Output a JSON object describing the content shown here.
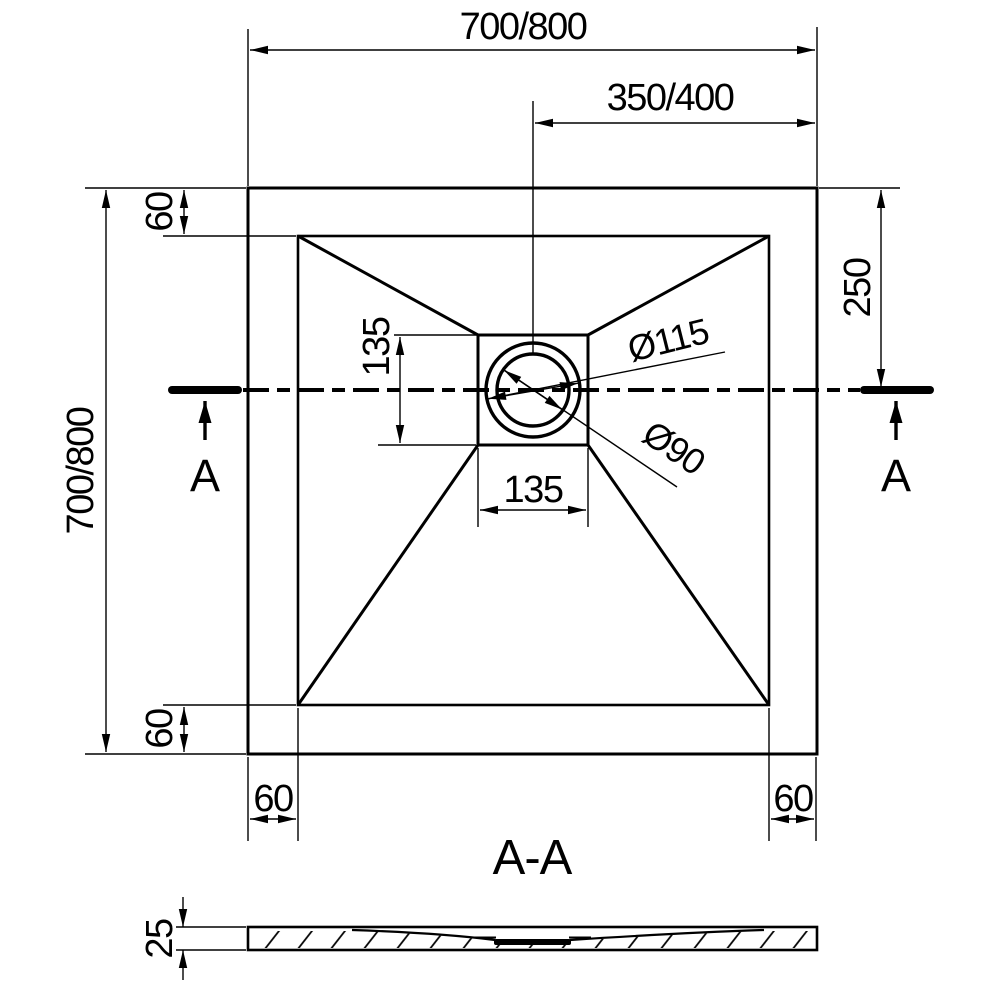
{
  "plan": {
    "dim_width_top": "700/800",
    "dim_width_half": "350/400",
    "dim_height_left": "700/800",
    "dim_border_top": "60",
    "dim_border_bottom": "60",
    "dim_border_bottom_left": "60",
    "dim_border_bottom_right": "60",
    "dim_center_offset_right": "250",
    "dim_drain_square_height": "135",
    "dim_drain_square_width": "135",
    "dim_flange_outer_diameter": "Ø115",
    "dim_drain_inner_diameter": "Ø90",
    "section_marker_left": "A",
    "section_marker_right": "A"
  },
  "section": {
    "title": "A-A",
    "dim_thickness": "25"
  },
  "colors": {
    "line": "#000000",
    "background": "#ffffff"
  }
}
